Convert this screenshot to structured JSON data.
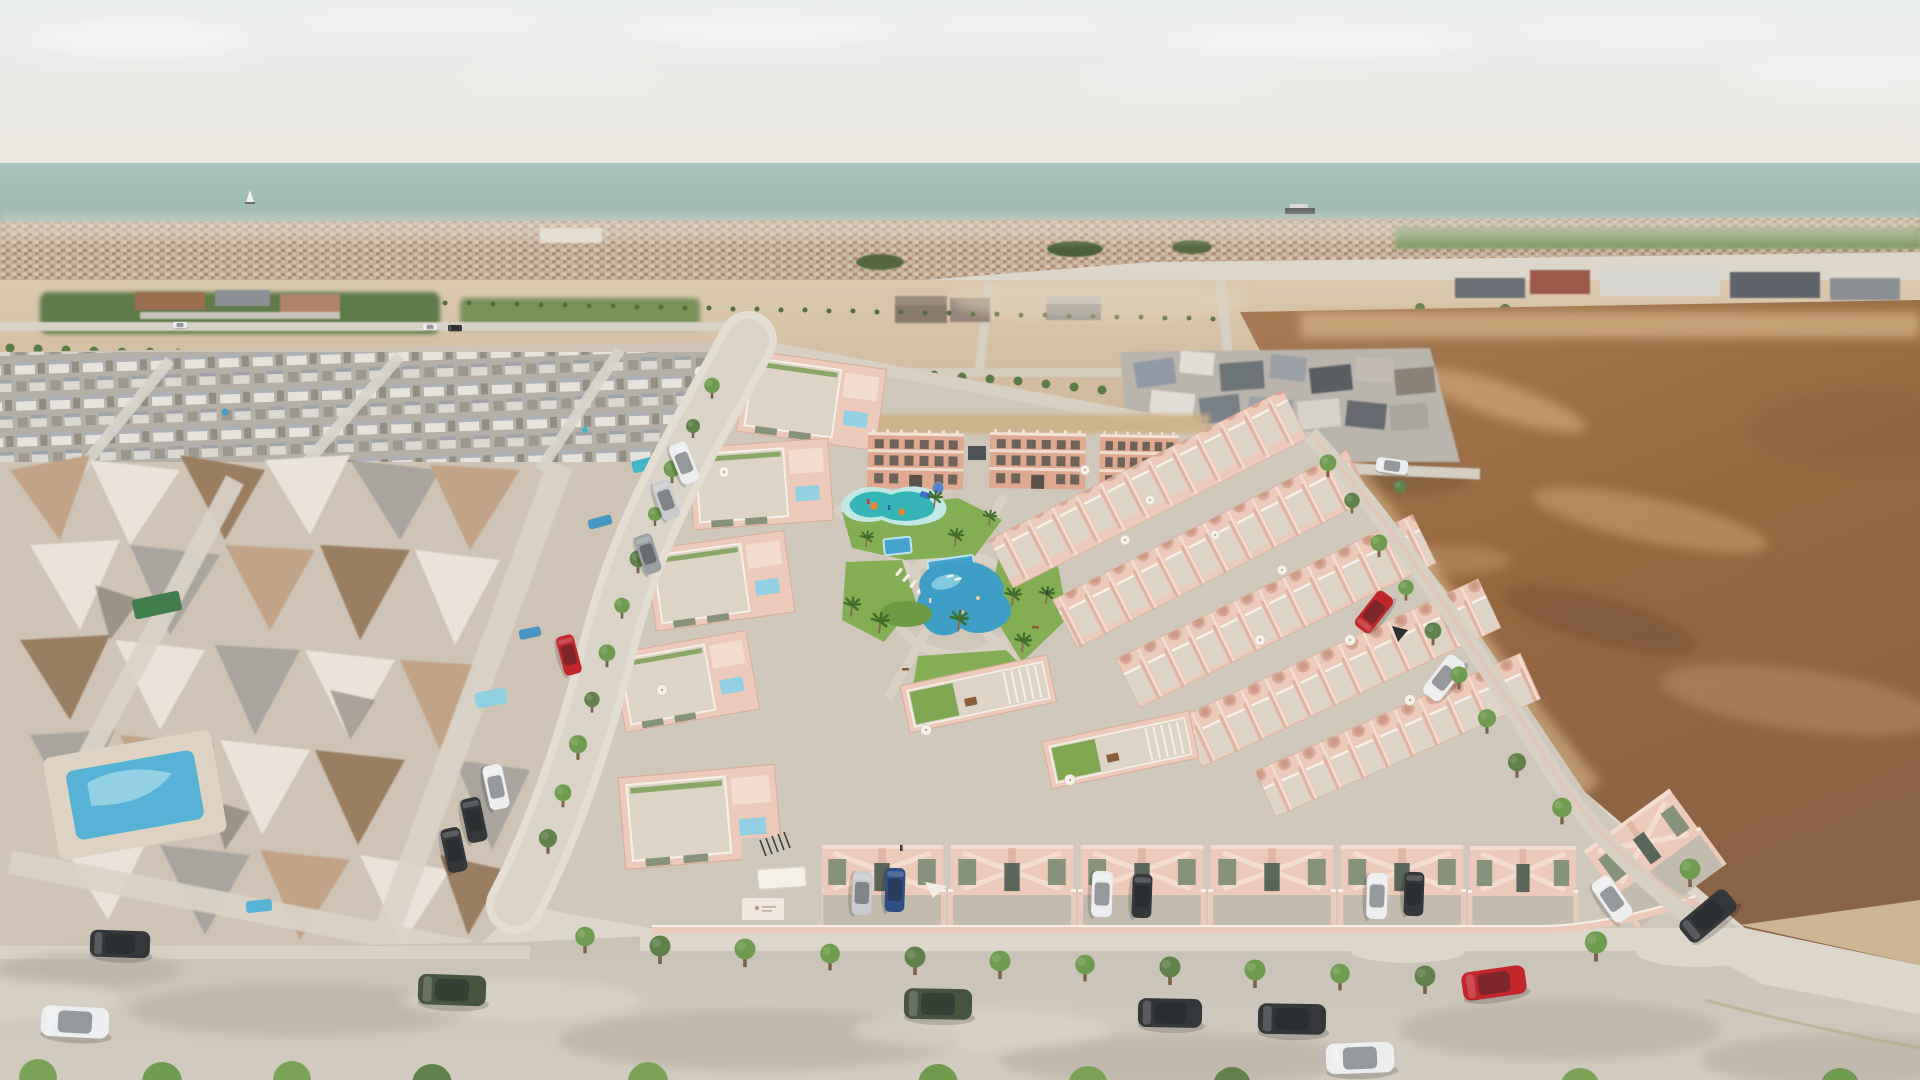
{
  "meta": {
    "image_type": "3D aerial architectural rendering",
    "description": "Aerial 3D render of a new-build Mediterranean residential development: salmon-pink townhouses and three small apartment blocks arranged around a landscaped communal garden with a lagoon-style pool, kids splash pad, plunge pools and palm trees. An existing low-poly photogrammetry neighborhood sits to the left, vacant tan plots and a large brown dirt field surround the site, a distant coastal town and pale teal sea line the horizon, and tree-lined streets with parked cars frame the foreground."
  },
  "palette": {
    "skyTop": "#e8eceb",
    "skyLow": "#ebe9e3",
    "cloud": "#f5f5f3",
    "sea": "#a7c2ba",
    "seaDeep": "#9ab7ae",
    "cityBase": "#c4ae98",
    "cityLight": "#dccbb5",
    "cityRoof": "#b1866b",
    "cityHaze": "#e7e0d4",
    "fieldGreen": "#7e9a63",
    "grove": "#5d7a46",
    "grove2": "#6f8c51",
    "treeRow": "#5d7c44",
    "dirt1": "#dbc8ac",
    "dirt2": "#cbb092",
    "sand": "#e2d3b9",
    "sandEdge": "#cdab7f",
    "bigDirt": "#a0744f",
    "bigDirt2": "#8a6244",
    "dirtStreak": "#c79e6f",
    "dirtDark": "#74523a",
    "meshBase": "#cec3b4",
    "meshWhite": "#e9e3d9",
    "meshGray": "#a9a59e",
    "meshBlue": "#8f99a3",
    "meshTan": "#c3a385",
    "meshBrown": "#9b7d61",
    "meshDark": "#6a635a",
    "villa": "#e7e4de",
    "villaRoof": "#aab0b8",
    "roadL": "#dad3c8",
    "road": "#c7bfb3",
    "sidewalk": "#ddd6ca",
    "paver": "#c3bcae",
    "plate": "#cfc8ba",
    "pink": "#ecc9b8",
    "pinkL": "#f4dccf",
    "pinkD": "#d9a896",
    "pinkWall": "#e7c0b1",
    "aptPink": "#dfa88f",
    "white": "#f6f0e8",
    "terrace": "#ded4c6",
    "winOlive": "#87927b",
    "winDark": "#5b665a",
    "poolBlue": "#429fc8",
    "poolLight": "#93cfe2",
    "splash": "#35b5b8",
    "splashDeck": "#c2e8e4",
    "orange": "#e08a3c",
    "playBlue": "#3a72c8",
    "grass": "#84ae54",
    "hedge": "#6d9a44",
    "palm": "#3f6e2e",
    "treeGreen": "#6f9c4e",
    "trunk": "#7d614b",
    "carWhite": "#eceef0",
    "carBlack": "#35383b",
    "carGray": "#9aa0a4",
    "carSilver": "#c8ccce",
    "carRed": "#c1272a",
    "carGreen": "#47543f",
    "carBlue": "#2e4f86"
  },
  "scene": {
    "sky": {
      "element": "hazy pale sky with soft clouds"
    },
    "sea": {
      "element": "pale teal sea band on horizon",
      "vessels": [
        "sailboat",
        "cargo ship"
      ]
    },
    "horizon_city": {
      "element": "distant low-rise coastal town rooftops"
    },
    "midground": {
      "features": [
        "orchard fields",
        "warehouse sheds",
        "industrial buildings",
        "circular reservoir",
        "tree-lined plot roads",
        "vacant tan plots"
      ]
    },
    "left_neighborhood": {
      "element": "existing neighborhood rendered as low-poly photogrammetry mesh",
      "features": [
        "white villa rows",
        "melted tan house mesh",
        "private pools",
        "green awning"
      ]
    },
    "development": {
      "apartment_blocks": 3,
      "west_townhouse_blocks": 5,
      "northeast_townhouse_rows": 5,
      "front_townhouses": 7,
      "amenities": [
        "lagoon pool",
        "kids splash pad",
        "plunge pools",
        "sun loungers",
        "palm trees",
        "lawns",
        "playground slide",
        "rooftop terraces",
        "pergolas",
        "entrance canopy",
        "bike racks"
      ],
      "rooftop_features": [
        "plunge pools",
        "parasols",
        "dining sets",
        "green roofs"
      ]
    },
    "right_field": {
      "element": "large vacant brown dirt field with lighter streaks"
    },
    "vehicles": {
      "on_foreground_road": [
        "white sedan",
        "dark sedan",
        "green SUV",
        "green SUV",
        "dark sedan",
        "black SUV",
        "white coupe",
        "red hatchback",
        "dark sedan"
      ],
      "in_driveways": [
        "silver",
        "blue",
        "white",
        "dark",
        "white",
        "dark",
        "white"
      ],
      "on_left_street": [
        "white",
        "silver",
        "gray",
        "red",
        "white",
        "dark",
        "dark"
      ],
      "on_right_road": [
        "red car",
        "white van"
      ]
    }
  }
}
